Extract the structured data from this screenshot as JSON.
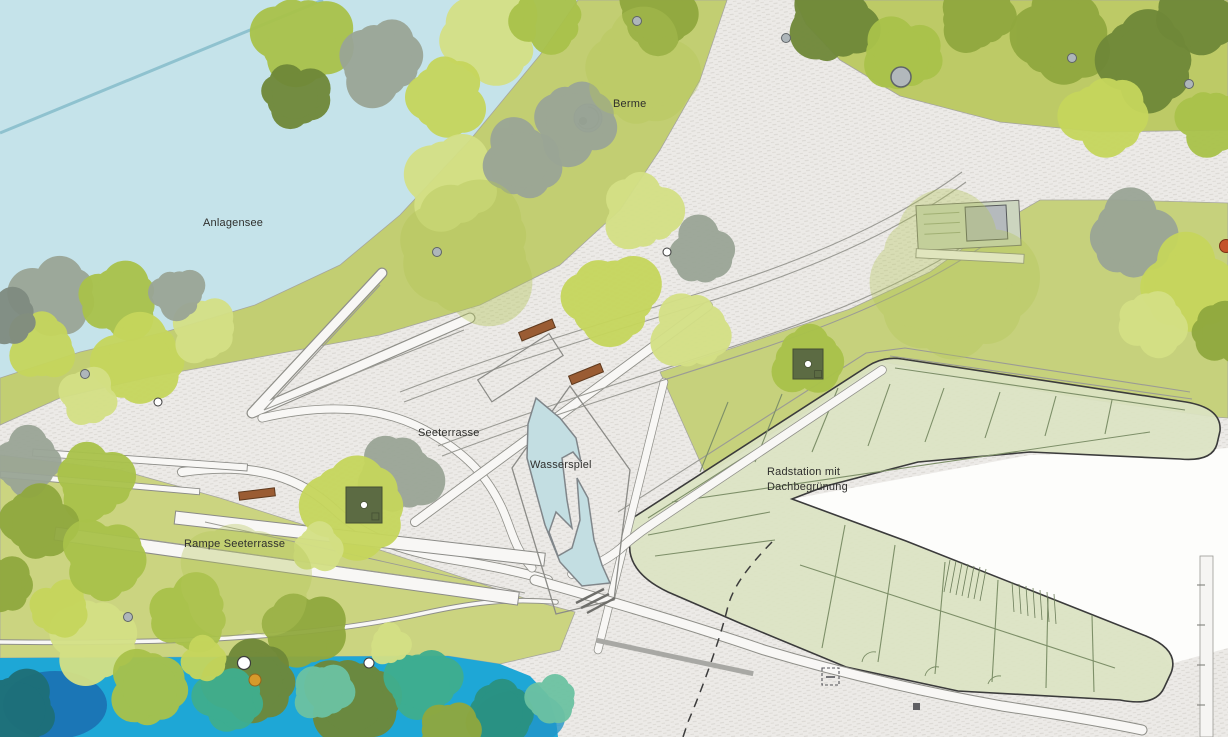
{
  "labels": {
    "anlagensee": "Anlagensee",
    "berme": "Berme",
    "seeterrasse": "Seeterrasse",
    "wasserspiel": "Wasserspiel",
    "rampe_seeterrasse": "Rampe Seeterrasse",
    "radstation_line1": "Radstation mit",
    "radstation_line2": "Dachbegrünung"
  },
  "colors": {
    "lake": "#c5e3ea",
    "lake_line": "#8fc2cf",
    "water": "#1ea7d6",
    "water_feature": "#c3dee2",
    "paving": "#eceae7",
    "paving_mark": "#d7d4cf",
    "lawn_berm": "#c2ce72",
    "lawn_b": "#bdca66",
    "lawn_c": "#c6d17c",
    "lawn_e": "#cbd480",
    "roof": "#dce3c3",
    "roof_line": "#7d8f68",
    "outline": "#3b3b3b",
    "bench": "#9a5c33",
    "planter": "#5c6b43",
    "label": "#2f2f2d",
    "trees": {
      "gy": "#9aa596",
      "gy2": "#7f8b80",
      "g1": "#c6d65c",
      "g2": "#d4e085",
      "g3": "#a9c24a",
      "g4": "#90a83e",
      "g5": "#6f8838",
      "t1": "#3fae8e",
      "t2": "#2a9180",
      "t3": "#6cc2a2",
      "db": "#1e6f77",
      "patch": "#b4c658"
    }
  },
  "map": {
    "trees": [
      [
        55,
        298,
        40,
        "gy"
      ],
      [
        120,
        300,
        38,
        "g3"
      ],
      [
        42,
        345,
        34,
        "g1"
      ],
      [
        140,
        362,
        44,
        "g1"
      ],
      [
        205,
        330,
        32,
        "g2"
      ],
      [
        88,
        396,
        28,
        "g2"
      ],
      [
        8,
        318,
        28,
        "gy2"
      ],
      [
        178,
        294,
        26,
        "gy"
      ],
      [
        28,
        462,
        33,
        "gy"
      ],
      [
        95,
        482,
        38,
        "g3"
      ],
      [
        38,
        522,
        36,
        "g4"
      ],
      [
        398,
        476,
        40,
        "gy"
      ],
      [
        357,
        506,
        50,
        "g1"
      ],
      [
        318,
        548,
        24,
        "g2"
      ],
      [
        302,
        40,
        46,
        "g3"
      ],
      [
        382,
        62,
        42,
        "gy"
      ],
      [
        295,
        96,
        32,
        "g5"
      ],
      [
        492,
        36,
        48,
        "g2"
      ],
      [
        446,
        96,
        38,
        "g1"
      ],
      [
        548,
        18,
        34,
        "g3"
      ],
      [
        452,
        182,
        46,
        "g2"
      ],
      [
        522,
        160,
        38,
        "gy"
      ],
      [
        575,
        122,
        40,
        "gy"
      ],
      [
        642,
        212,
        38,
        "g2"
      ],
      [
        612,
        300,
        46,
        "g1"
      ],
      [
        692,
        332,
        38,
        "g2"
      ],
      [
        702,
        252,
        32,
        "gy"
      ],
      [
        658,
        14,
        38,
        "g4"
      ],
      [
        832,
        24,
        42,
        "g5"
      ],
      [
        902,
        56,
        38,
        "g3"
      ],
      [
        978,
        18,
        36,
        "g4"
      ],
      [
        1062,
        34,
        48,
        "g4"
      ],
      [
        1148,
        60,
        48,
        "g5"
      ],
      [
        1106,
        116,
        40,
        "g1"
      ],
      [
        1194,
        14,
        38,
        "g5"
      ],
      [
        1212,
        122,
        33,
        "g3"
      ],
      [
        1132,
        236,
        42,
        "gy"
      ],
      [
        1188,
        286,
        46,
        "g1"
      ],
      [
        1225,
        332,
        32,
        "g4"
      ],
      [
        1152,
        322,
        32,
        "g2"
      ],
      [
        808,
        360,
        34,
        "g3"
      ],
      [
        95,
        640,
        42,
        "g2"
      ],
      [
        190,
        614,
        38,
        "g3"
      ],
      [
        150,
        688,
        38,
        "g3"
      ],
      [
        302,
        630,
        38,
        "g4"
      ],
      [
        252,
        682,
        42,
        "g5"
      ],
      [
        352,
        700,
        44,
        "g5"
      ],
      [
        60,
        610,
        28,
        "g1"
      ],
      [
        18,
        710,
        38,
        "db"
      ],
      [
        230,
        700,
        32,
        "t1"
      ],
      [
        322,
        692,
        28,
        "t3"
      ],
      [
        424,
        684,
        36,
        "t1"
      ],
      [
        500,
        712,
        32,
        "t2"
      ],
      [
        205,
        660,
        22,
        "g1"
      ],
      [
        448,
        730,
        28,
        "g4"
      ],
      [
        552,
        700,
        24,
        "t3"
      ],
      [
        390,
        645,
        20,
        "g2"
      ],
      [
        105,
        560,
        40,
        "g3"
      ],
      [
        0,
        585,
        30,
        "g4"
      ],
      [
        470,
        250,
        70,
        "patch",
        0.4
      ],
      [
        950,
        280,
        80,
        "patch",
        0.35
      ],
      [
        240,
        580,
        60,
        "patch",
        0.35
      ],
      [
        640,
        70,
        55,
        "patch",
        0.35
      ]
    ],
    "trunks": [
      [
        437,
        252,
        "gray"
      ],
      [
        85,
        374,
        "gray"
      ],
      [
        128,
        617,
        "gray"
      ],
      [
        158,
        402,
        "white4"
      ],
      [
        667,
        252,
        "white4"
      ],
      [
        901,
        77,
        "big"
      ],
      [
        637,
        21,
        "gray"
      ],
      [
        786,
        38,
        "gray"
      ],
      [
        1072,
        58,
        "gray"
      ],
      [
        1189,
        84,
        "gray"
      ],
      [
        244,
        663,
        "white6"
      ],
      [
        369,
        663,
        "white5"
      ],
      [
        255,
        680,
        "orange"
      ],
      [
        1226,
        246,
        "red"
      ]
    ],
    "benches": [
      [
        537,
        330,
        36,
        9,
        -22
      ],
      [
        586,
        374,
        34,
        9,
        -22
      ],
      [
        257,
        494,
        36,
        8,
        -7
      ]
    ],
    "bars": [
      [
        140,
        460,
        215,
        7,
        4,
        "w"
      ],
      [
        100,
        483,
        200,
        6,
        5,
        "w"
      ],
      [
        970,
        256,
        108,
        9,
        3,
        "w"
      ],
      [
        675,
        657,
        160,
        5,
        12,
        "g"
      ]
    ],
    "planters": [
      [
        364,
        505,
        36
      ],
      [
        808,
        364,
        30
      ]
    ]
  }
}
